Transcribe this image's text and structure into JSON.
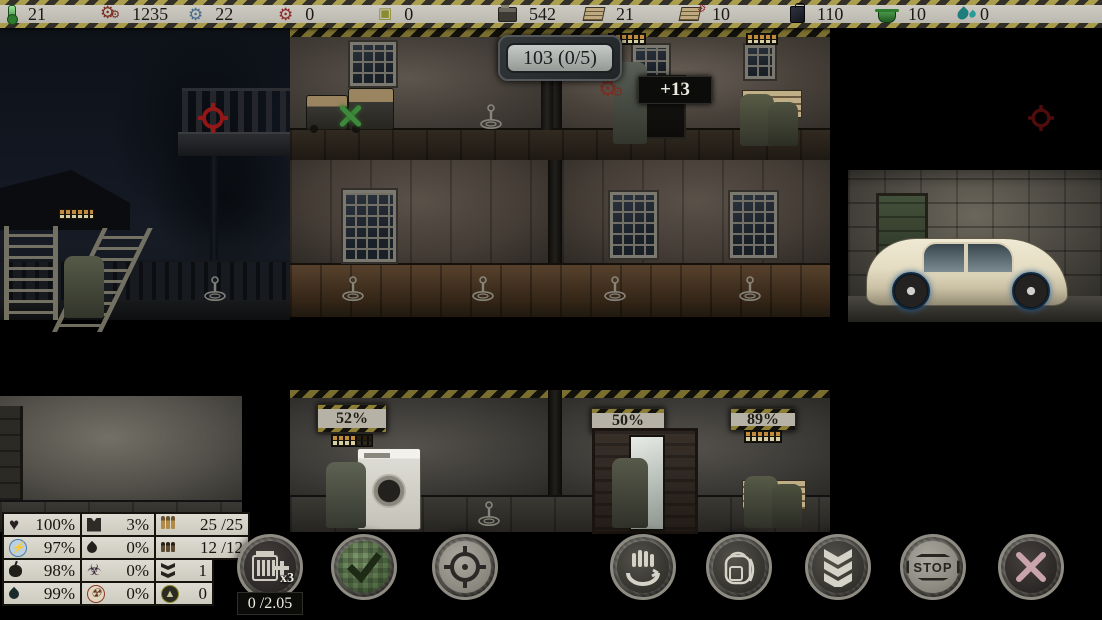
{
  "top_bar": {
    "resources": [
      {
        "name": "temperature",
        "icon": "thermometer-icon",
        "value": "21"
      },
      {
        "name": "scrap",
        "icon": "gears-icon",
        "value": "1235",
        "color": "#7a2e22"
      },
      {
        "name": "parts",
        "icon": "blue-gear-icon",
        "value": "22",
        "color": "#4a6e8e"
      },
      {
        "name": "wheels",
        "icon": "red-wheel-icon",
        "value": "0",
        "color": "#8e2a2a"
      },
      {
        "name": "electronics",
        "icon": "chip-icon",
        "value": "0",
        "color": "#8a8a2e"
      },
      {
        "name": "machines",
        "icon": "press-icon",
        "value": "542"
      },
      {
        "name": "planks",
        "icon": "planks-icon",
        "value": "21"
      },
      {
        "name": "plank-parts",
        "icon": "planks-gear-icon",
        "value": "10"
      },
      {
        "name": "fuel",
        "icon": "jerrycan-icon",
        "value": "110"
      },
      {
        "name": "food",
        "icon": "pot-icon",
        "value": "10"
      },
      {
        "name": "water",
        "icon": "water-drops-icon",
        "value": "0"
      }
    ]
  },
  "scene": {
    "room_number_sign": "103 (0/5)",
    "reward_popup": "+13",
    "signs": {
      "laundry_room": "52%",
      "wardrobe_room": "50%",
      "storage_room": "89%"
    }
  },
  "stats_panel": {
    "rows": [
      {
        "cells": [
          {
            "icon": "health-icon",
            "value": "100%"
          },
          {
            "icon": "armor-icon",
            "value": "3%"
          },
          {
            "icon": "rifle-ammo-icon",
            "value": "25 /25"
          }
        ]
      },
      {
        "cells": [
          {
            "icon": "energy-icon",
            "value": "97%"
          },
          {
            "icon": "blood-icon",
            "value": "0%"
          },
          {
            "icon": "pistol-ammo-icon",
            "value": "12 /12"
          }
        ]
      },
      {
        "cells": [
          {
            "icon": "food-icon",
            "value": "98%"
          },
          {
            "icon": "infection-icon",
            "value": "0%"
          },
          {
            "icon": "descend-icon",
            "value": "1"
          }
        ]
      },
      {
        "cells": [
          {
            "icon": "water-icon",
            "value": "99%"
          },
          {
            "icon": "radiation-icon",
            "value": "0%"
          },
          {
            "icon": "level-up-icon",
            "value": "0"
          }
        ]
      }
    ]
  },
  "action_bar": {
    "ammo_button": {
      "multiplier": "x3",
      "timer": "0 /2.05"
    },
    "stop_label": "STOP",
    "accent_green": "#4f6a42",
    "accent_red": "#a01818"
  }
}
